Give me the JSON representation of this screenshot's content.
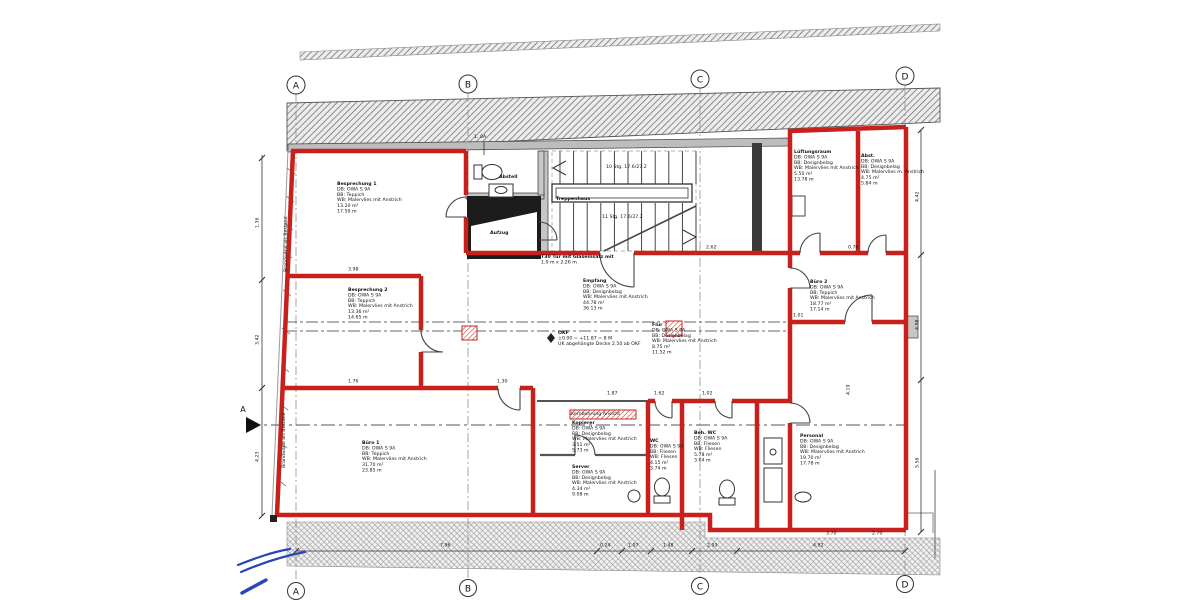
{
  "grid": {
    "top": [
      "A",
      "B",
      "C",
      "D"
    ],
    "bottom": [
      "A",
      "B",
      "C",
      "D"
    ]
  },
  "rooms": [
    {
      "id": "besprechung-1",
      "lines": [
        "Besprechung 1",
        "DB: OWA S 9A",
        "BB: Teppich",
        "WB: Malervlies mit Anstrich",
        "13.20 m²",
        "17.59 m"
      ]
    },
    {
      "id": "besprechung-2",
      "lines": [
        "Besprechung 2",
        "DB: OWA S 9A",
        "BB: Teppich",
        "WB: Malervlies mit Anstrich",
        "13.36 m²",
        "14.65 m"
      ]
    },
    {
      "id": "buero-1",
      "lines": [
        "Büro 1",
        "DB: OWA S 9A",
        "BB: Teppich",
        "WB: Malervlies mit Anstrich",
        "31.70 m²",
        "23.85 m"
      ]
    },
    {
      "id": "empfang",
      "lines": [
        "Empfang",
        "DB: OWA S 9A",
        "BB: Designbelag",
        "WB: Malervlies mit Anstrich",
        "44.78 m²",
        "36.13 m"
      ]
    },
    {
      "id": "flur",
      "lines": [
        "Flur",
        "DB: OWA S 9A",
        "BB: Designbelag",
        "WB: Malervlies mit Anstrich",
        "8.75 m²",
        "11.52 m"
      ]
    },
    {
      "id": "buero-2",
      "lines": [
        "Büro 2",
        "DB: OWA S 9A",
        "BB: Teppich",
        "WB: Malervlies mit Anstrich",
        "18.77 m²",
        "17.14 m"
      ]
    },
    {
      "id": "lueftungsraum",
      "lines": [
        "Lüftungsraum",
        "DB: OWA S 9A",
        "BB: Designbelag",
        "WB: Malervlies mit Anstrich",
        "5.50 m²",
        "13.78 m"
      ]
    },
    {
      "id": "abstellraum",
      "lines": [
        "Abst.",
        "DB: OWA S 9A",
        "BB: Designbelag",
        "WB: Malervlies m. Anstrich",
        "4.75 m²",
        "5.84 m"
      ]
    },
    {
      "id": "kopierer",
      "lines": [
        "Kopierer",
        "DB: OWA S 9A",
        "BB: Designbelag",
        "WB: Malervlies mit Anstrich",
        "3.51 m²",
        "5.73 m"
      ]
    },
    {
      "id": "server",
      "lines": [
        "Server",
        "DB: OWA S 9A",
        "BB: Designbelag",
        "WB: Malervlies mit Anstrich",
        "4.34 m²",
        "9.08 m"
      ]
    },
    {
      "id": "wc",
      "lines": [
        "WC",
        "DB: OWA S 9A",
        "BB: Fliesen",
        "WB: Fliesen",
        "4.15 m²",
        "3.74 m"
      ]
    },
    {
      "id": "beh-wc",
      "lines": [
        "Beh. WC",
        "DB: OWA S 9A",
        "BB: Fliesen",
        "WB: Fliesen",
        "5.78 m²",
        "3.64 m"
      ]
    },
    {
      "id": "personal",
      "lines": [
        "Personal",
        "DB: OWA S 9A",
        "BB: Designbelag",
        "WB: Malervlies mit Anstrich",
        "19.70 m²",
        "17.78 m"
      ]
    },
    {
      "id": "treppenhaus",
      "lines": [
        "Treppenhaus"
      ]
    },
    {
      "id": "aufzug",
      "lines": [
        "Aufzug"
      ]
    },
    {
      "id": "abstell-wc",
      "lines": [
        "Abstell"
      ]
    }
  ],
  "annotations": {
    "wall_type": "1. 0A",
    "stairs_up": "10 Stg. 17.6/27.2",
    "stairs_down": "11 Stg. 17.6/27.2",
    "level": [
      "OKF",
      "±0.00 = +11.87 = 8 M",
      "UK abgehängte Decke 2.50 ab OKF"
    ],
    "door_note": [
      "T30 Tür mit Glaseinsatz mit",
      "1.0 m x 2.26 m"
    ],
    "core_drill": "Kernbohrung Ansicht",
    "party_wall_upper": "Brandwand als Bestand",
    "party_wall_lower": "Brandwand als Bestand",
    "section_marker": "A"
  },
  "dimensions": {
    "bottom": [
      "7.96",
      "0.24",
      "1.07",
      "1.48",
      "2.93",
      "4.92"
    ],
    "left": [
      "1.36",
      "3.42",
      "4.23"
    ],
    "right": [
      "4.42",
      "4.58",
      "5.56"
    ],
    "inner": [
      "3.98",
      "1.76",
      "2.62",
      "0.76",
      "1.01",
      "1.87",
      "1.62",
      "1.02",
      "2.70",
      "3.70",
      "1.30",
      "4.19"
    ]
  },
  "colors": {
    "wall_red": "#c8201d",
    "ink_blue": "#2746b8"
  }
}
